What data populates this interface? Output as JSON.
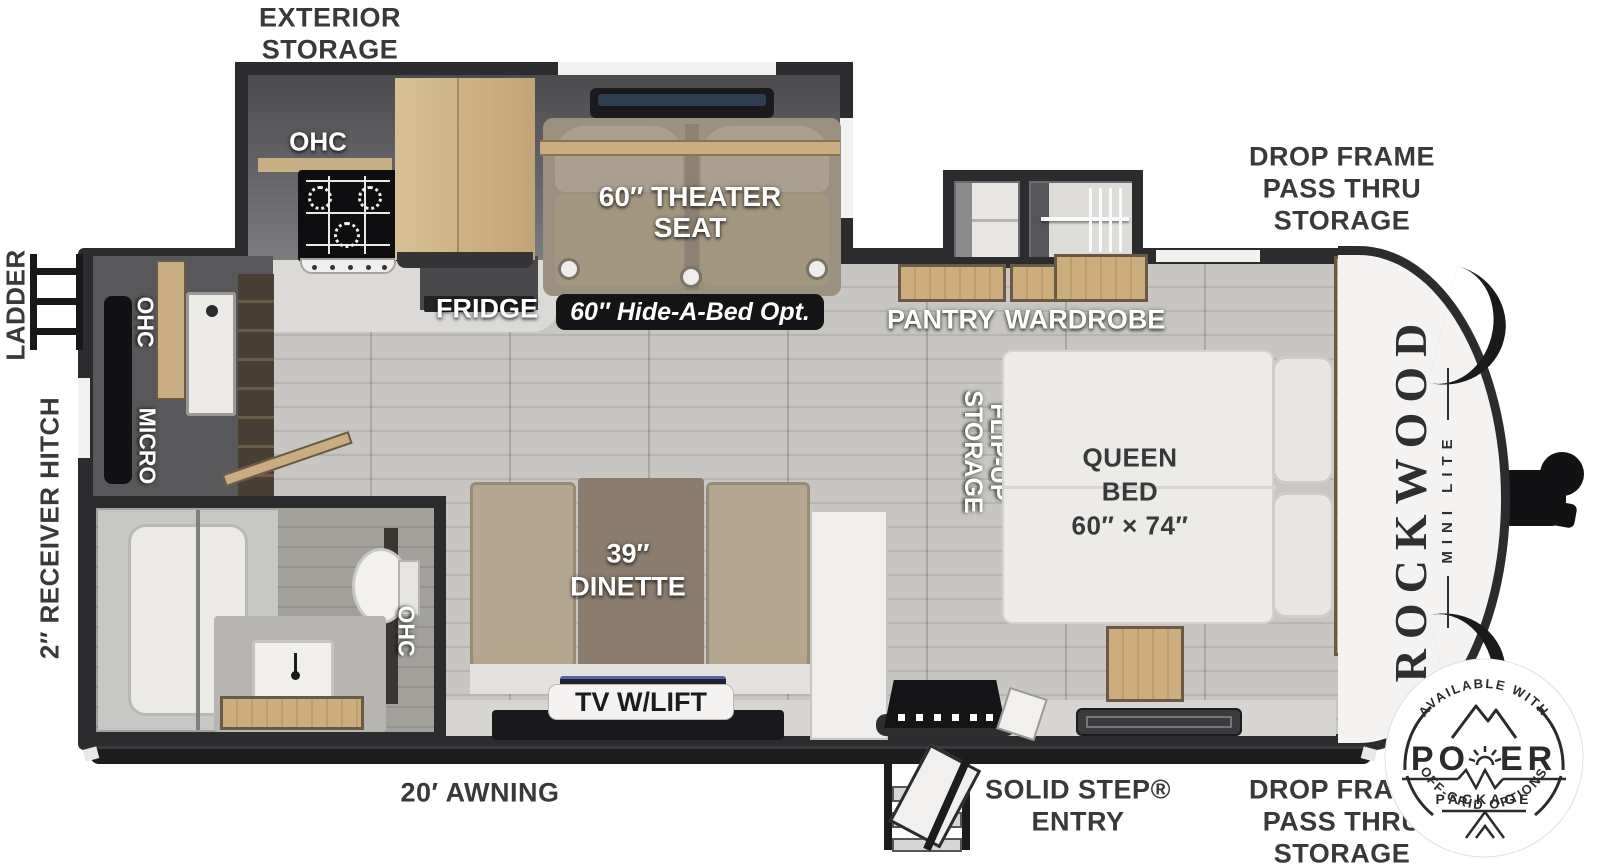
{
  "exterior": {
    "storage": [
      "EXTERIOR",
      "STORAGE"
    ],
    "drop_frame_front": [
      "DROP FRAME",
      "PASS THRU",
      "STORAGE"
    ],
    "drop_frame_rear": [
      "DROP FRAME",
      "PASS THRU",
      "STORAGE"
    ],
    "ladder": "LADDER",
    "receiver_hitch": "2″ RECEIVER HITCH",
    "awning": "20′ AWNING",
    "entry": [
      "SOLID STEP®",
      "ENTRY"
    ]
  },
  "kitchen": {
    "ohc": "OHC",
    "wall_ohc": "OHC",
    "micro": "MICRO",
    "fridge": "FRIDGE"
  },
  "living": {
    "theater_seat": [
      "60″ THEATER",
      "SEAT"
    ],
    "hide_a_bed": "60″ Hide-A-Bed Opt.",
    "dinette": [
      "39″",
      "DINETTE"
    ],
    "tv": "TV W/LIFT"
  },
  "storage_areas": {
    "pantry": "PANTRY",
    "wardrobe": "WARDROBE",
    "flip_up": [
      "FLIP-UP",
      "STORAGE"
    ]
  },
  "bathroom": {
    "ohc": "OHC"
  },
  "bedroom": {
    "queen_bed": [
      "QUEEN",
      "BED",
      "60″ × 74″"
    ],
    "ohc": "OHC"
  },
  "brand": {
    "name": "ROCKWOOD",
    "model": "MINI LITE"
  },
  "badge": {
    "top": "AVAILABLE WITH",
    "power_left": "PO",
    "power_right": "ER",
    "package": "PACKAGE",
    "bottom": "OFF-GRID OPTIONS"
  },
  "colors": {
    "wall": "#2c2c2e",
    "wood": "#c3a87b",
    "floor": "#c8c6c2",
    "label_dark": "#39393b"
  }
}
